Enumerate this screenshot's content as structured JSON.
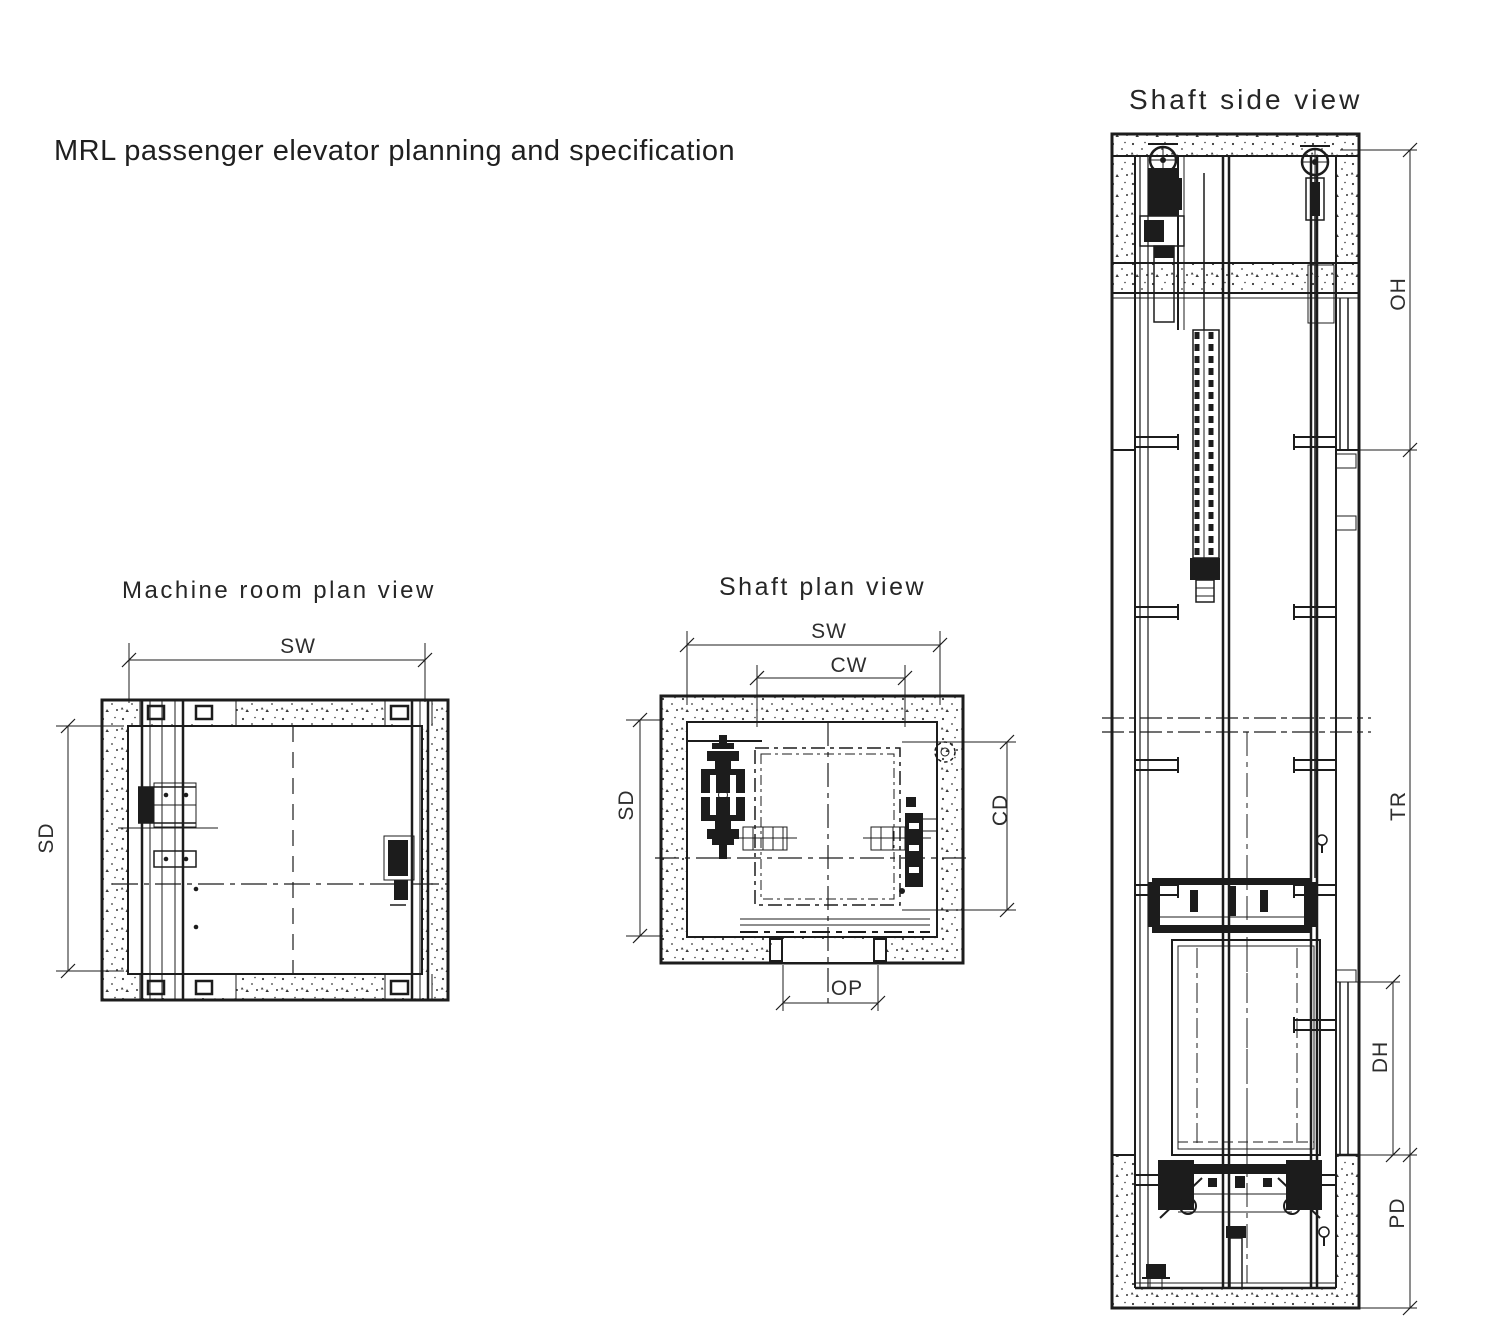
{
  "page_title": "MRL passenger elevator planning and specification",
  "machine_room_view": {
    "title": "Machine room plan view",
    "labels": {
      "sw": "SW",
      "sd": "SD"
    }
  },
  "shaft_plan_view": {
    "title": "Shaft plan view",
    "labels": {
      "sw": "SW",
      "cw": "CW",
      "sd": "SD",
      "cd": "CD",
      "op": "OP"
    }
  },
  "shaft_side_view": {
    "title": "Shaft side view",
    "labels": {
      "oh": "OH",
      "tr": "TR",
      "dh": "DH",
      "pd": "PD"
    }
  },
  "colors": {
    "line": "#1c1c1c",
    "background": "#ffffff"
  }
}
